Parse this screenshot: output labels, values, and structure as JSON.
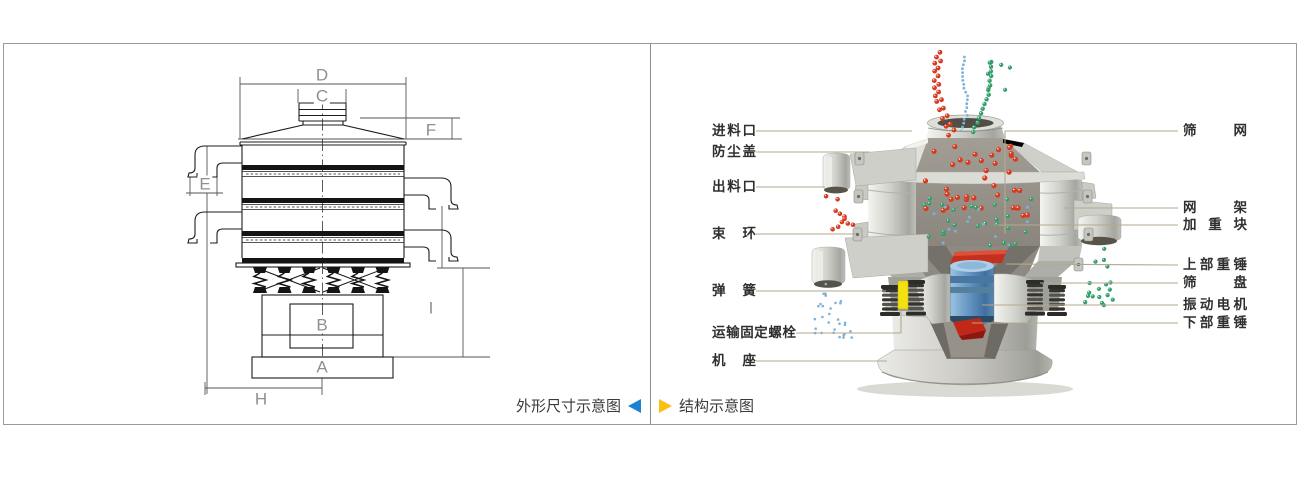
{
  "colors": {
    "accent_blue": "#1b83d2",
    "accent_yellow": "#fbbf14",
    "leader_line": "#b3a98e",
    "particle_red": "#d63a1f",
    "particle_green": "#2f9e68",
    "particle_blue": "#7fb2d8",
    "motor_blue": "#5888b4",
    "weight_red": "#c43020",
    "highlight_yellow": "#f2e212",
    "border_gray": "#9a9a9a",
    "dimension_letter_gray": "#8f8f8f"
  },
  "left_panel": {
    "caption": "外形尺寸示意图",
    "dimension_labels": {
      "top_width": "D",
      "inlet_width": "C",
      "inlet_height": "F",
      "outlet_height": "E",
      "motor_box": "B",
      "base_width": "A",
      "base_half_width": "H",
      "lower_height": "I"
    }
  },
  "right_panel": {
    "caption": "结构示意图",
    "labels_left": [
      "进料口",
      "防尘盖",
      "出料口",
      "束环",
      "弹簧",
      "运输固定螺栓",
      "机座"
    ],
    "labels_right": [
      "筛网",
      "网架",
      "加重块",
      "上部重锤",
      "筛盘",
      "振动电机",
      "下部重锤"
    ]
  }
}
